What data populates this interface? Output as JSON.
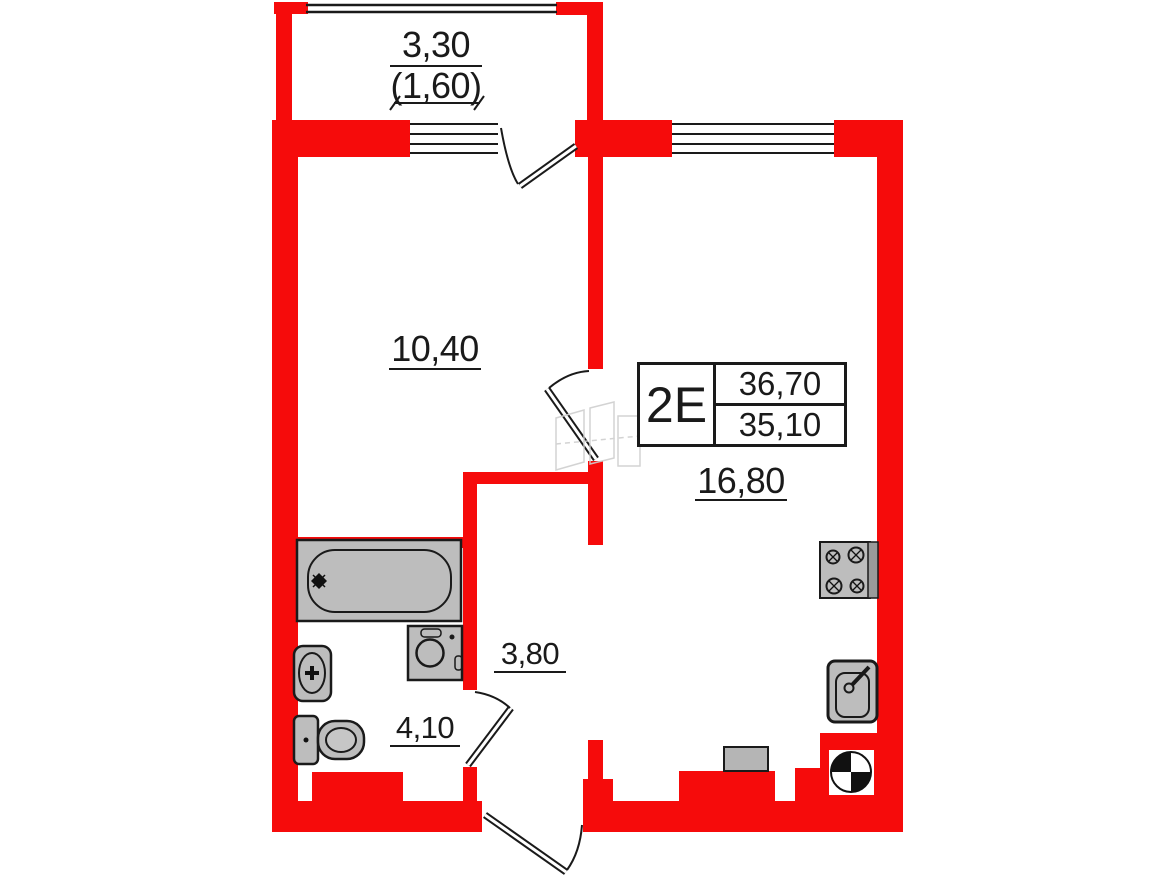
{
  "document": {
    "type": "apartment-floor-plan"
  },
  "stamp": {
    "unit_label": "2E",
    "value_top": "36,70",
    "value_bottom": "35,10"
  },
  "dimensions": {
    "balcony_width": "3,30",
    "balcony_area": "(1,60)",
    "room1_area": "10,40",
    "living_area": "16,80",
    "hall_area": "3,80",
    "bath_area": "4,10"
  },
  "colors": {
    "wall": "#f60b0b",
    "line": "#1a1a1a",
    "fixture_fill": "#bdbdbd"
  },
  "fixtures": [
    "bathtub",
    "wash-basin",
    "toilet",
    "washing-machine",
    "stove",
    "kitchen-sink",
    "vent-shaft",
    "cabinet"
  ]
}
